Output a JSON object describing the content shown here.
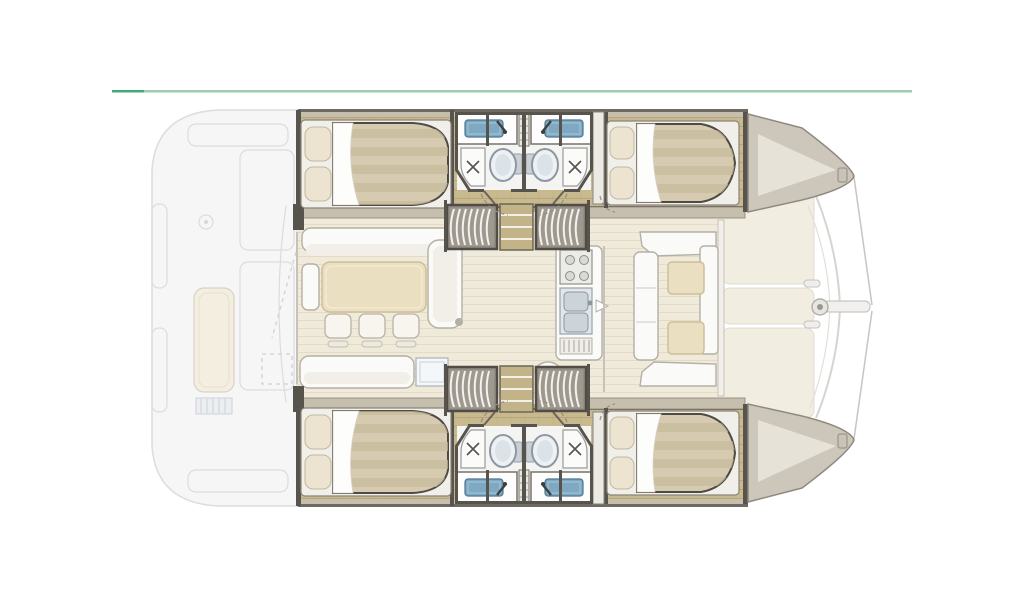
{
  "meta": {
    "type": "floor-plan-diagram",
    "subject": "catamaran sailing yacht interior layout, top-down view, bow to the right",
    "layout_version": "4 cabins / 4 bathrooms"
  },
  "divider": {
    "left_color": "#45a87c",
    "right_color": "#9ccdb2"
  },
  "colors": {
    "ghost-fill": "#f6f6f7",
    "ghost-line": "#dcdcdf",
    "hull-wood": "#c8b98e",
    "hull-wood-line": "#b2a276",
    "deck-trim": "#c6bfae",
    "wall-dark": "#57534d",
    "salon-floor": "#f0eadb",
    "salon-floor-line": "#e2dac6",
    "mattress": "#d6cbb1",
    "mattress-stripe": "#c6b99c",
    "pillow": "#ece4d0",
    "bed-base": "#f1efea",
    "sheet": "#fdfdfc",
    "furniture-white": "#fafaf8",
    "furniture-line": "#b5b0a5",
    "table-wood": "#eadfc1",
    "sink-blue": "#7fa9c2",
    "porcelain": "#eef1f3",
    "porcelain-line": "#8e98a1",
    "stair-bg": "#948f85",
    "stair-tread": "#f3f2ee",
    "bow-deck": "#cdc6ba",
    "foredeck-panel": "#f1ede0",
    "rigging": "#c6c5c1",
    "divider-left": "#45a87c",
    "divider-right": "#9ccdb2"
  },
  "regions": [
    {
      "id": "salon",
      "label": "Salon: L-settee, dining table with three stools, chaise, galley with stove and double sink"
    },
    {
      "id": "cockpit",
      "label": "Aft cockpit and transom steps (exterior, ghosted)"
    },
    {
      "id": "port-hull",
      "label": "Port hull: aft double cabin, two bathrooms with sink, toilet and shower, forward double cabin, companionway stairs"
    },
    {
      "id": "starboard-hull",
      "label": "Starboard hull: aft double cabin, two bathrooms with sink, toilet and shower, forward double cabin, companionway stairs"
    },
    {
      "id": "foredeck",
      "label": "Foredeck lockers, forward crossbeam, bowsprit and rigging"
    },
    {
      "id": "divider-rule",
      "label": "Horizontal accent rule above the plan"
    },
    {
      "id": "forward-dinette",
      "label": "Forward cockpit dinette with two wooden tables"
    }
  ]
}
